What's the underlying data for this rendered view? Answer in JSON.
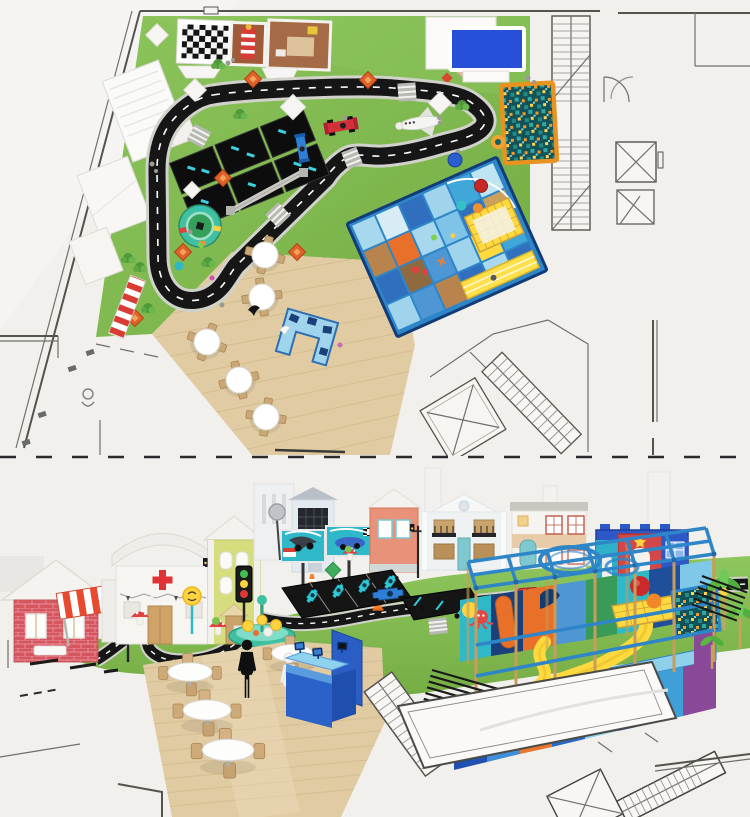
{
  "meta": {
    "description": "Indoor kids playground concept drawing: 2D top-view floor plan (upper panel) and 3D perspective render (lower panel), both overlaid on an architectural CAD floor plan",
    "canvas": {
      "width": 750,
      "height": 817
    }
  },
  "palette": {
    "background": "#f2f0ed",
    "grass": "#7fb84e",
    "grass_light": "#8cc45c",
    "track": "#161616",
    "track_curb": "#d2d2cc",
    "track_dash": "#ffffff",
    "wood_floor": "#e0cba2",
    "frame_blue": "#2e86c8",
    "frame_navy": "#123c78",
    "panel_light_blue": "#9fd4ec",
    "panel_mid_blue": "#4f96d4",
    "panel_dark_blue": "#2f6fbe",
    "slide_yellow": "#ffd93e",
    "ballpit_border": "#e8931f",
    "cad_line": "#6f6f6c",
    "red": "#d5303a",
    "orange": "#f08a2e",
    "teal": "#2fb8c8",
    "awning_red": "#e8492f",
    "brick_red": "#d5565e",
    "counter_blue": "#2a62c8",
    "counter_top": "#8fd2ee",
    "carousel_teal": "#3fc0a0",
    "sign_yellow": "#ffd23f",
    "hospital_cross": "#e03434",
    "castle_blue": "#2c58c8",
    "castle_red": "#d24848"
  },
  "plan_view": {
    "label": "Top view floor plan",
    "items": [
      "checkered-flag-mat",
      "toy-display-frames",
      "white-canopy",
      "projection-screen",
      "go-kart-track",
      "zebra-crossings",
      "kart-parking-grid",
      "roundabout-carousel",
      "red-race-car",
      "blue-race-car",
      "space-shuttle-toy",
      "ball-pit",
      "soft-play-structure",
      "trampoline",
      "yellow-slide",
      "cafe-tables",
      "reception-desk",
      "safety-stripe-mat",
      "white-tents",
      "staircase",
      "elevator-shaft",
      "door-swings"
    ]
  },
  "perspective_view": {
    "label": "3D perspective render",
    "items": [
      "brick-shop-house",
      "hospital-facade",
      "green-town-house",
      "town-houses",
      "castle-facade",
      "race-billboards",
      "street-lamps",
      "traffic-light",
      "carousel-playset",
      "go-kart-track",
      "kart-parking",
      "scooters",
      "race-cars",
      "mushroom-decor",
      "road-signs",
      "cafe-tables",
      "reception-counter",
      "visitor-silhouettes",
      "soft-play-frame",
      "spiral-feature",
      "wavy-slide",
      "trampoline",
      "ball-pool",
      "plant-decor",
      "cad-stairs",
      "cad-elevator"
    ]
  }
}
